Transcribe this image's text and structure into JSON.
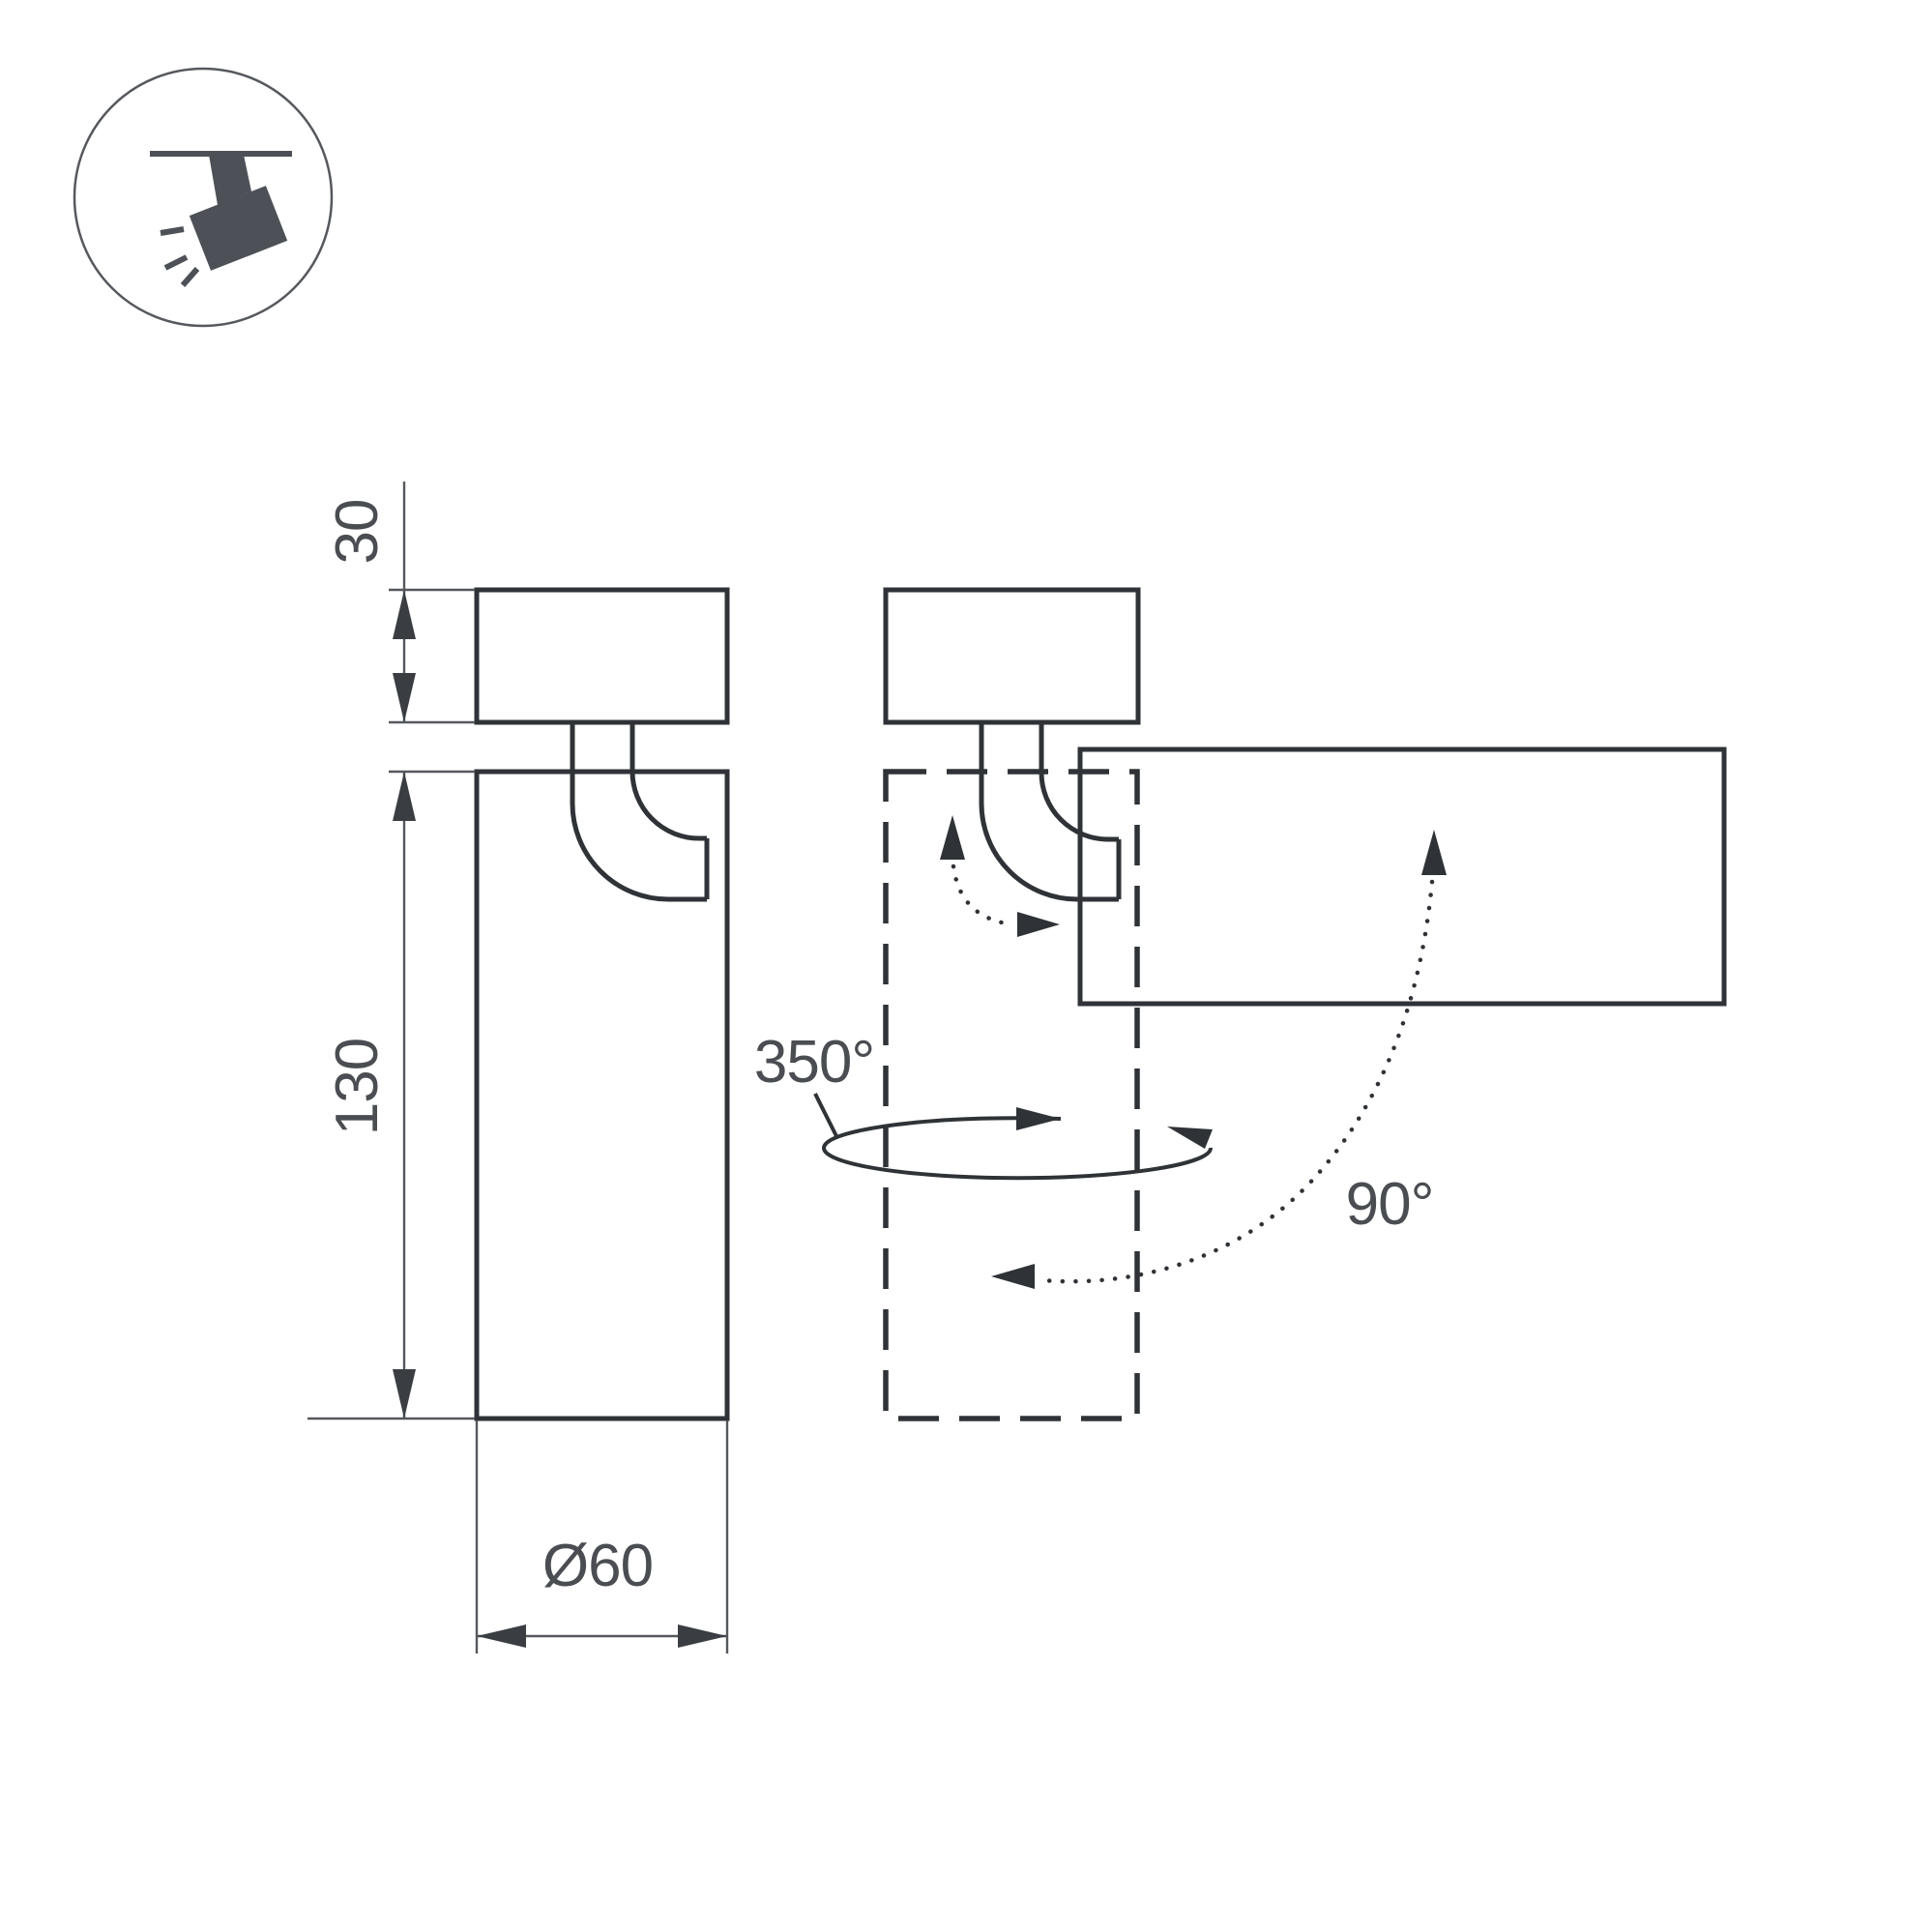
{
  "drawing": {
    "icon": {
      "name": "ceiling-track-spotlight"
    },
    "dimension_labels": {
      "base_height": "30",
      "body_length": "130",
      "diameter": "Ø60"
    },
    "rotation_labels": {
      "swivel": "350°",
      "tilt": "90°"
    },
    "colors": {
      "line": "#2f3337",
      "dimension_line": "#55585c",
      "text": "#4a4d51",
      "icon": "#4d5157",
      "background": "#ffffff"
    }
  }
}
